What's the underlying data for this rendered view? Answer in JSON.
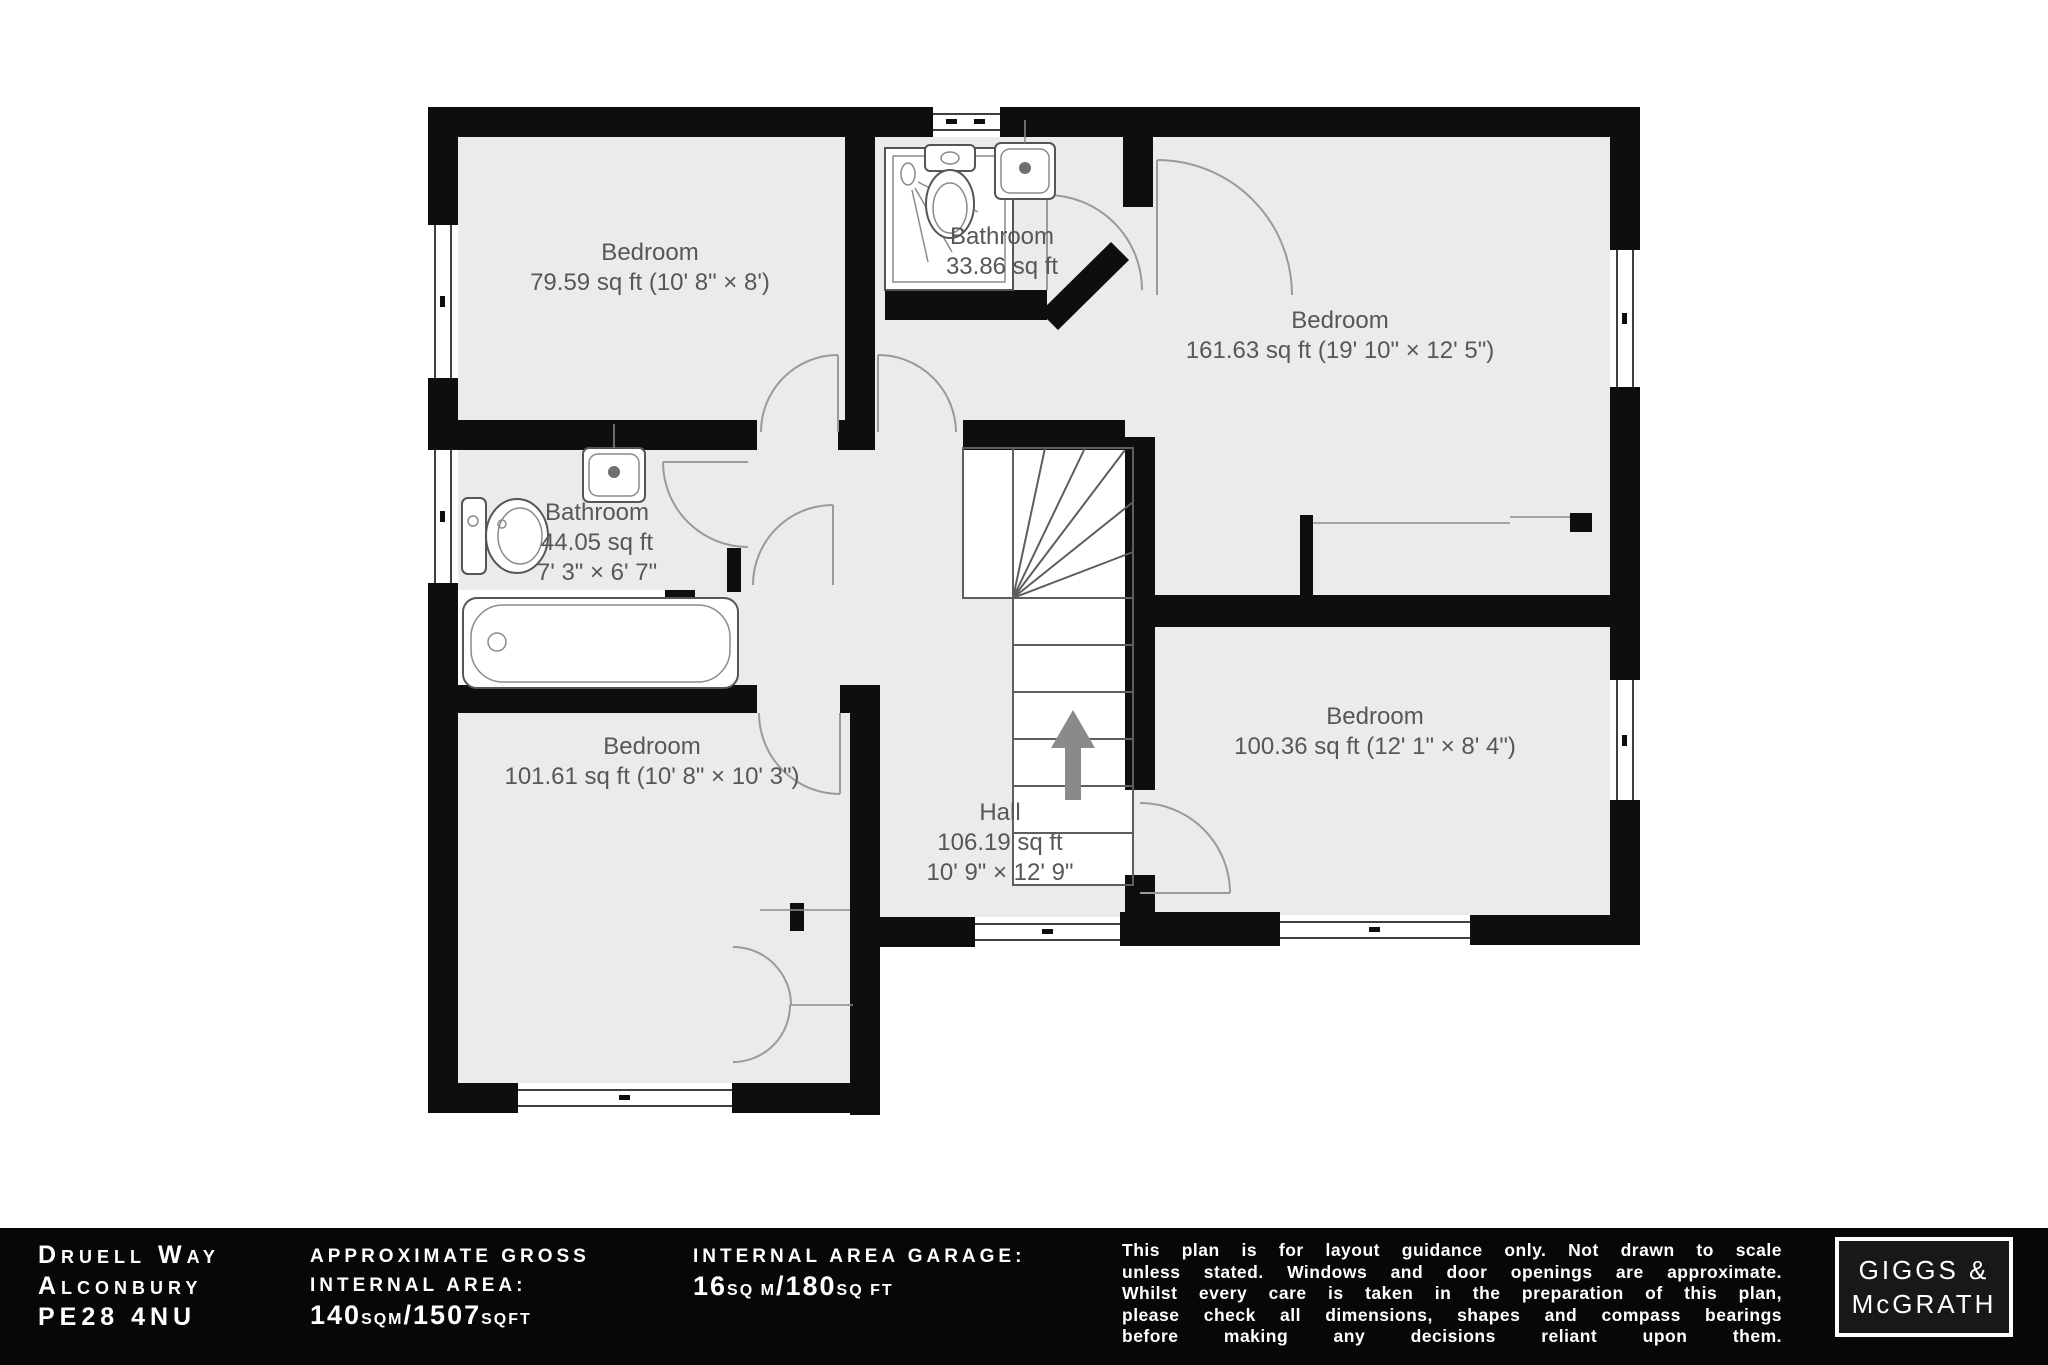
{
  "theme": {
    "wall": "#0e0e0e",
    "floor": "#ebebed",
    "line": "#5e5e5e",
    "arc": "#9a9a9a",
    "label": "#575757",
    "window_line": "#3f3f3f",
    "footer_bg": "#070707",
    "footer_text": "#ffffff",
    "logo_bg": "#18181a",
    "arrow": "#8a8a8a"
  },
  "plan": {
    "rooms": [
      {
        "name": "Bedroom",
        "area": "79.59 sq ft (10' 8\" × 8')"
      },
      {
        "name": "Bathroom",
        "area": "33.86 sq ft"
      },
      {
        "name": "Bedroom",
        "area": "161.63 sq ft (19' 10\" × 12' 5\")"
      },
      {
        "name": "Bathroom",
        "area": "44.05 sq ft",
        "dims": "7' 3\" × 6' 7\""
      },
      {
        "name": "Bedroom",
        "area": "101.61 sq ft (10' 8\" × 10' 3\")"
      },
      {
        "name": "Hall",
        "area": "106.19 sq ft",
        "dims": "10' 9\" × 12' 9\""
      },
      {
        "name": "Bedroom",
        "area": "100.36 sq ft (12' 1\" × 8' 4\")"
      }
    ]
  },
  "footer": {
    "address_line1": "Druell Way",
    "address_line2": "Alconbury",
    "address_line3": "PE28 4NU",
    "gross_label_line1": "approximate gross",
    "gross_label_line2": "internal area:",
    "gross_num1": "140",
    "gross_unit1": "sqm",
    "gross_sep": "/",
    "gross_num2": "1507",
    "gross_unit2": "sqft",
    "garage_label": "internal area garage:",
    "garage_num1": "16",
    "garage_unit1": "sq m",
    "garage_sep": "/",
    "garage_num2": "180",
    "garage_unit2": "sq ft",
    "disclaimer_lines": [
      "This plan is for layout guidance only. Not drawn to scale",
      "unless stated. Windows and door openings are approximate.",
      "Whilst every care is taken in the preparation of this plan,",
      "please check all dimensions, shapes and compass bearings",
      "before making any decisions reliant upon them.",
      ""
    ],
    "logo_line1": "GIGGS &",
    "logo_line2": "McGRATH"
  }
}
